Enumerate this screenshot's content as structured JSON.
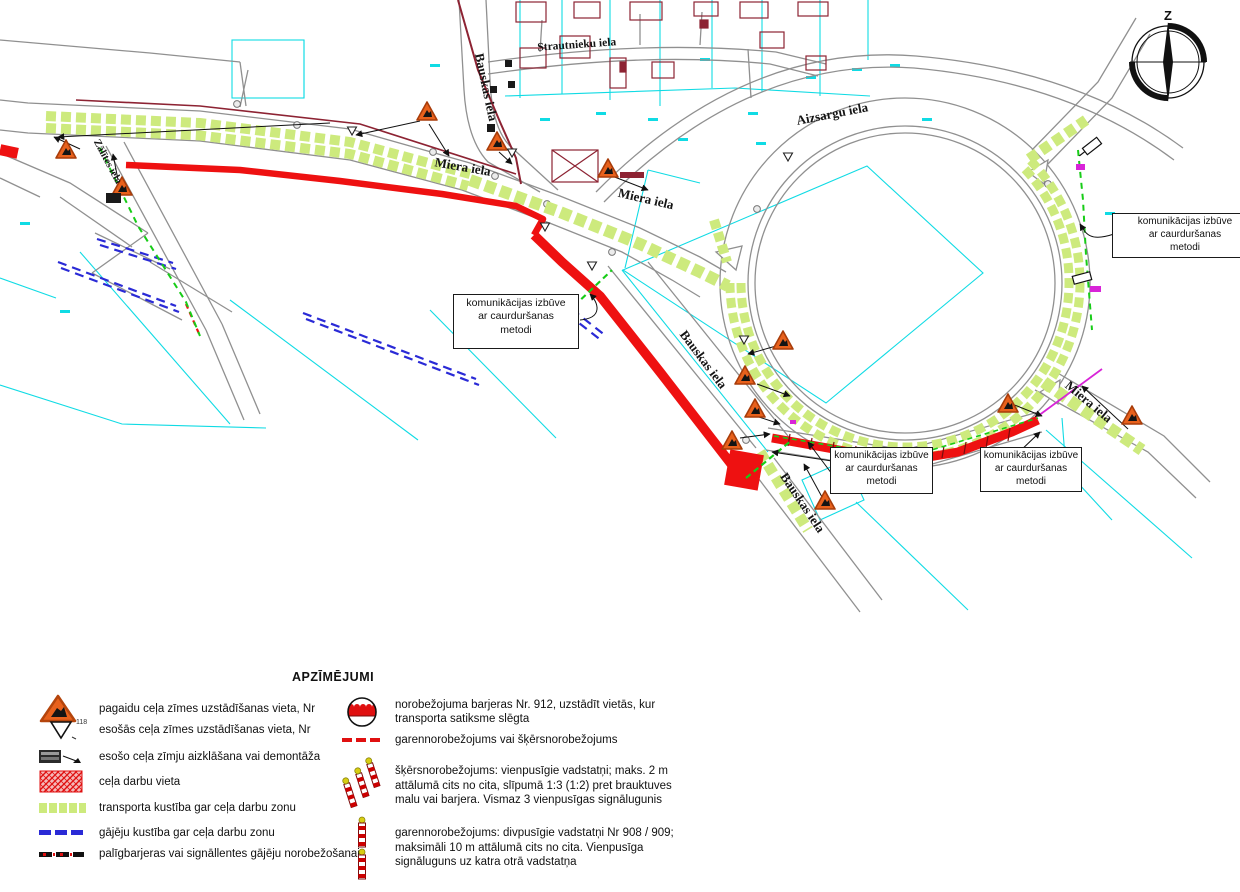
{
  "map": {
    "streets": {
      "miera": "Miera iela",
      "bauskas": "Bauskas iela",
      "aizsargu": "Aizsargu iela",
      "strautnieku": "Strautnieku iela",
      "zalites": "Zālītes iela"
    },
    "annotation": {
      "line1": "komunikācijas izbūve",
      "line2": "ar caurduršanas",
      "line3": "metodi"
    },
    "compass_label": "Z"
  },
  "legend": {
    "title": "APZĪMĒJUMI",
    "sign_number": "118",
    "left": [
      {
        "icon": "temporary-sign-triangle-icon",
        "text": "pagaidu ceļa zīmes uzstādīšanas vieta, Nr"
      },
      {
        "icon": "existing-sign-triangle-icon",
        "text": "esošās ceļa zīmes uzstādīšanas vieta, Nr"
      },
      {
        "icon": "sign-cover-icon",
        "text": "esošo ceļa zīmju aizklāšana vai demontāža"
      },
      {
        "icon": "work-area-hatch-icon",
        "text": "ceļa darbu vieta"
      },
      {
        "icon": "transport-route-dash-icon",
        "text": "transporta kustība gar ceļa darbu zonu"
      },
      {
        "icon": "pedestrian-route-dash-icon",
        "text": "gājēju kustība gar ceļa darbu zonu"
      },
      {
        "icon": "aux-barrier-dash-icon",
        "text": "palīgbarjeras vai signāllentes gājēju norobežošanai"
      }
    ],
    "right": [
      {
        "icon": "barrier-912-icon",
        "text": "norobežojuma barjeras Nr. 912, uzstādīt vietās, kur transporta satiksme slēgta"
      },
      {
        "icon": "delimiter-dash-icon",
        "text": "garennorobežojums vai šķērsnorobežojums"
      },
      {
        "icon": "cross-delimiter-posts-icon",
        "text": "šķērsnorobežojums: vienpusīgie vadstatņi; maks. 2 m attālumā cits no cita, slīpumā 1:3 (1:2) pret brauktuves malu vai barjera. Vismaz 3 vienpusīgas signālugunis"
      },
      {
        "icon": "longitudinal-delimiter-posts-icon",
        "text": "garennorobežojums: divpusīgie vadstatņi Nr 908 / 909; maksimāli 10 m attālumā cits no cita. Vienpusīga signāluguns uz katra otrā vadstatņa"
      }
    ]
  },
  "colors": {
    "work_zone_red": "#ee1111",
    "transport_band_green": "#cdea7d",
    "pedestrian_blue": "#2a2ad6",
    "communication_green": "#17cc17",
    "parcel_cyan": "#10dbe4",
    "building_maroon": "#8d2333",
    "sign_orange": "#e8611c",
    "magenta": "#d824d8",
    "road_gray": "#909090"
  }
}
